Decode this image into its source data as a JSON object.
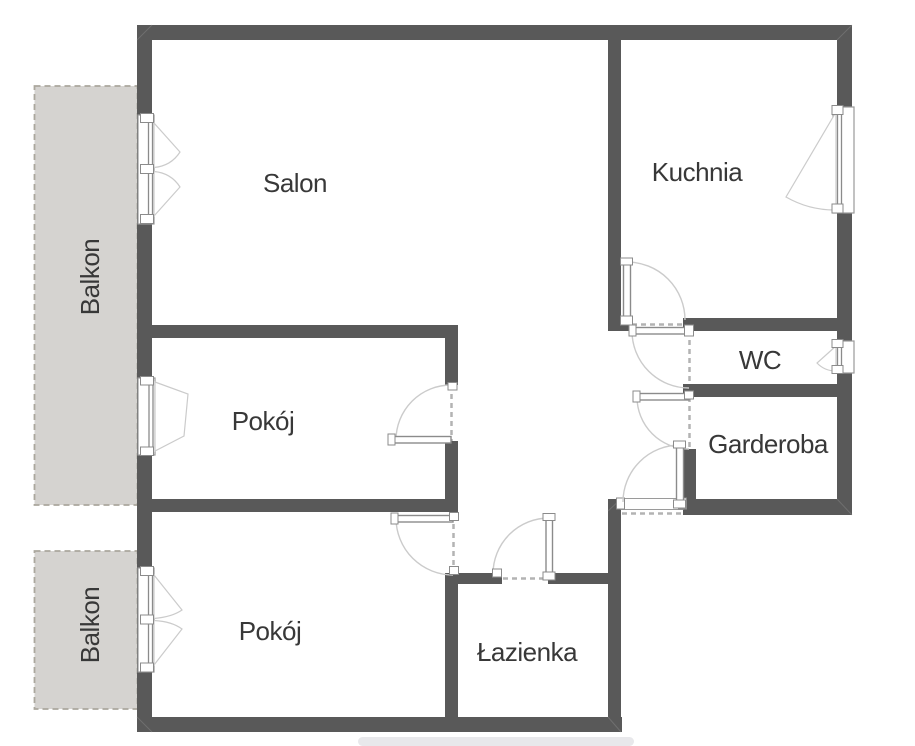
{
  "colors": {
    "wall": "#595959",
    "balcony_fill": "#d5d3d0",
    "balcony_border": "#aba79d",
    "sill_strip": "#eae3d3",
    "text": "#383838",
    "shadow": "#e2e2e6",
    "background": "#ffffff"
  },
  "rooms": {
    "salon": {
      "label": "Salon"
    },
    "kuchnia": {
      "label": "Kuchnia"
    },
    "wc": {
      "label": "WC"
    },
    "garderoba": {
      "label": "Garderoba"
    },
    "pokoj_middle": {
      "label": "Pokój"
    },
    "pokoj_bottom": {
      "label": "Pokój"
    },
    "lazienka": {
      "label": "Łazienka"
    },
    "balkon_top": {
      "label": "Balkon"
    },
    "balkon_bottom": {
      "label": "Balkon"
    }
  }
}
